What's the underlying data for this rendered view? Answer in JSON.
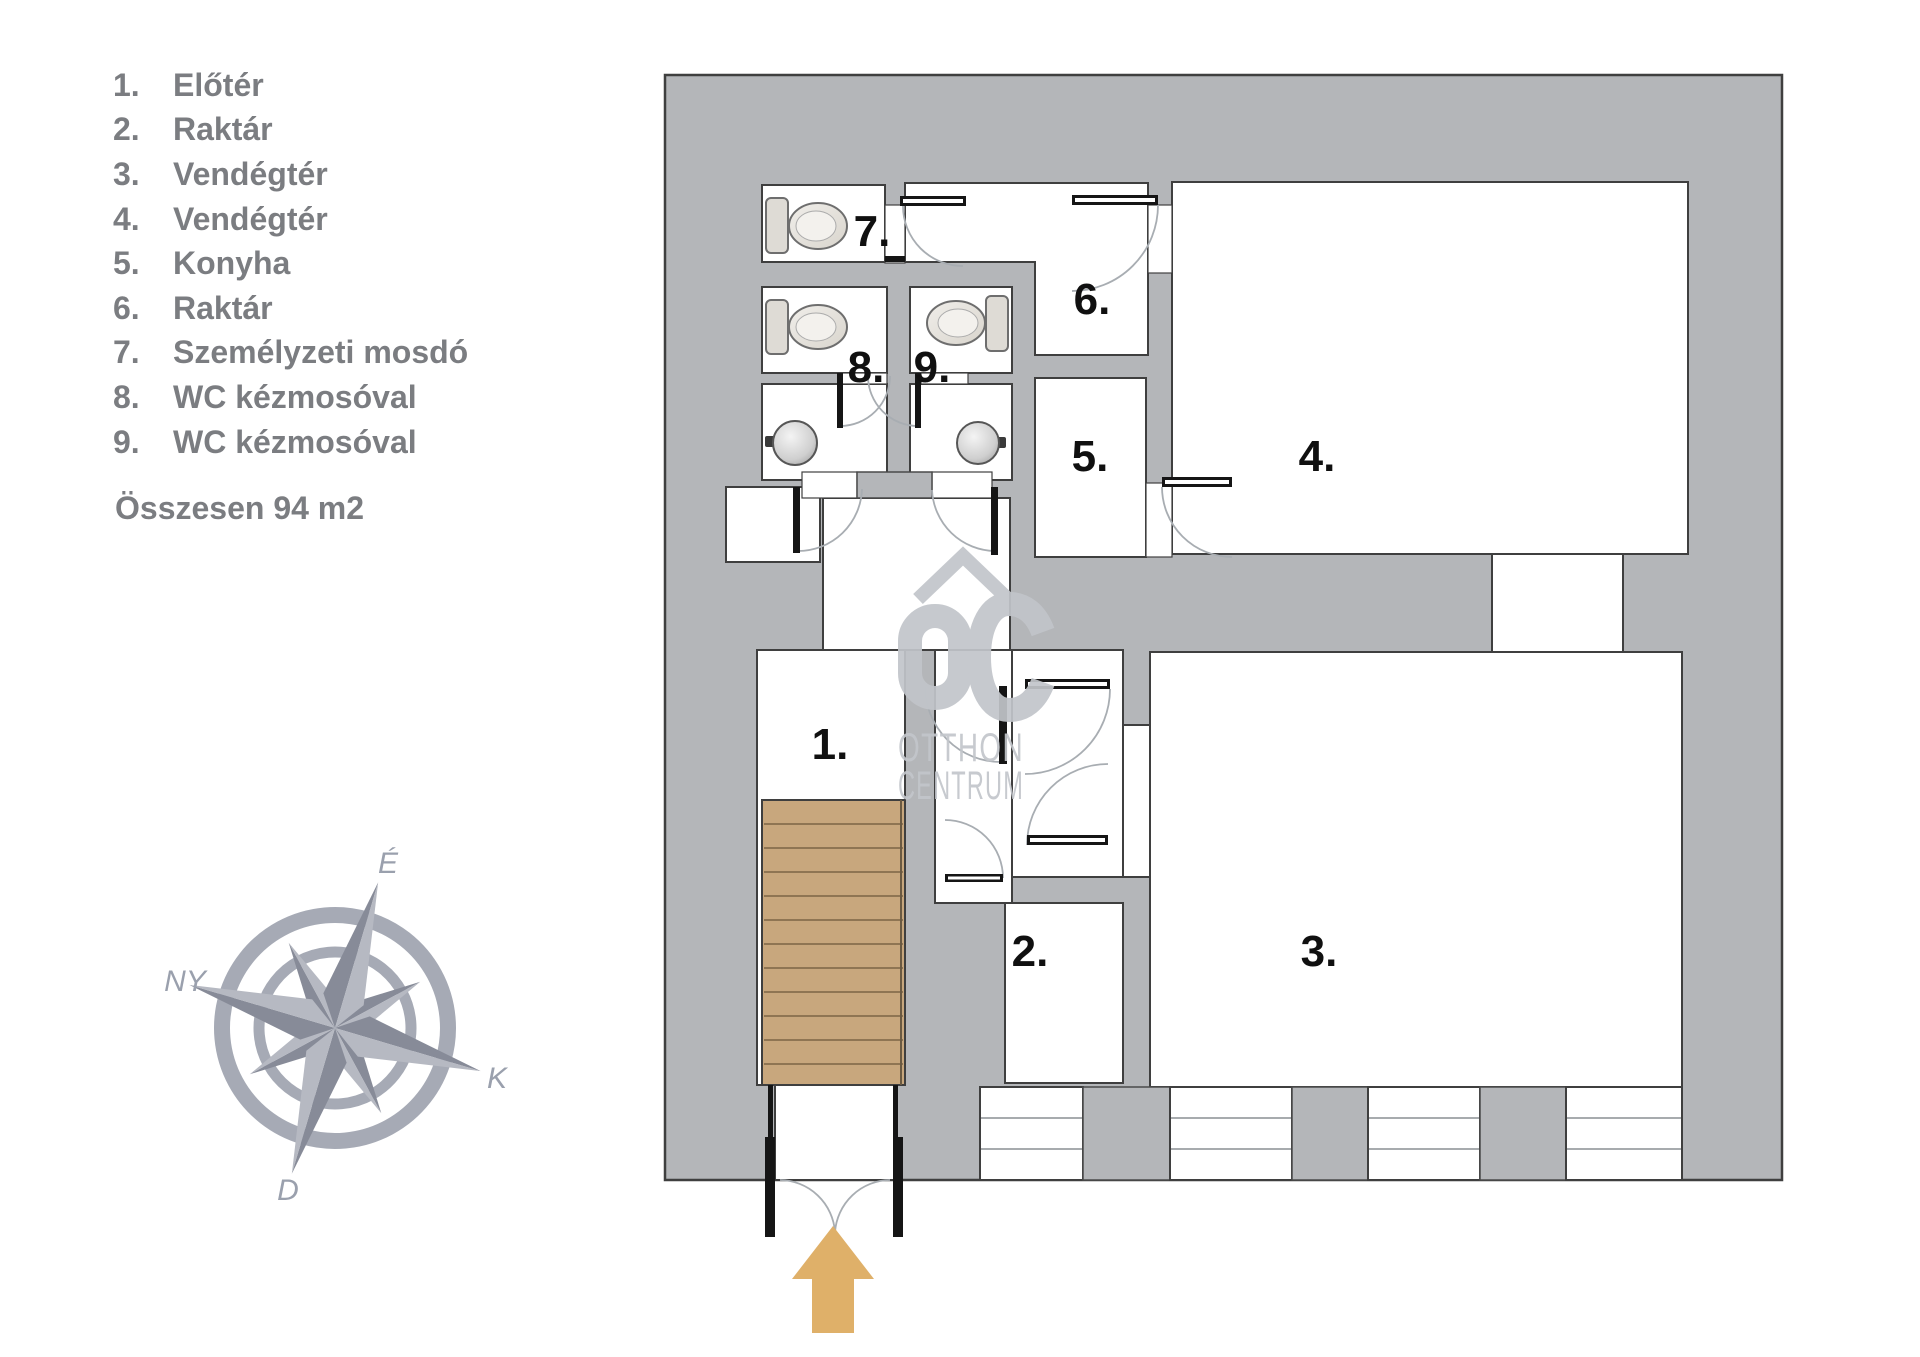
{
  "legend": {
    "items": [
      {
        "num": "1.",
        "label": "Előtér"
      },
      {
        "num": "2.",
        "label": "Raktár"
      },
      {
        "num": "3.",
        "label": "Vendégtér"
      },
      {
        "num": "4.",
        "label": "Vendégtér"
      },
      {
        "num": "5.",
        "label": "Konyha"
      },
      {
        "num": "6.",
        "label": "Raktár"
      },
      {
        "num": "7.",
        "label": "Személyzeti mosdó"
      },
      {
        "num": "8.",
        "label": "WC kézmosóval"
      },
      {
        "num": "9.",
        "label": "WC kézmosóval"
      }
    ],
    "total": "Összesen 94 m2"
  },
  "compass": {
    "north": "É",
    "west": "NY",
    "east": "K",
    "south": "D"
  },
  "plan": {
    "rooms": {
      "r1": "1.",
      "r2": "2.",
      "r3": "3.",
      "r4": "4.",
      "r5": "5.",
      "r6": "6.",
      "r7": "7.",
      "r8": "8.",
      "r9": "9."
    }
  },
  "watermark": {
    "logo": "OC",
    "line1": "OTTHON",
    "line2": "CENTRUM"
  },
  "colors": {
    "wall": "#b4b6b9",
    "outline": "#3f3f3f",
    "stairs": "#c8a77d",
    "stair_line": "#8f7553",
    "arrow": "#dfb069",
    "legend_text": "#7b7d81",
    "room_number": "#101010",
    "compass": "#a6aab5",
    "watermark": "#c2c5ca",
    "fixture": "#e8e5e0"
  }
}
